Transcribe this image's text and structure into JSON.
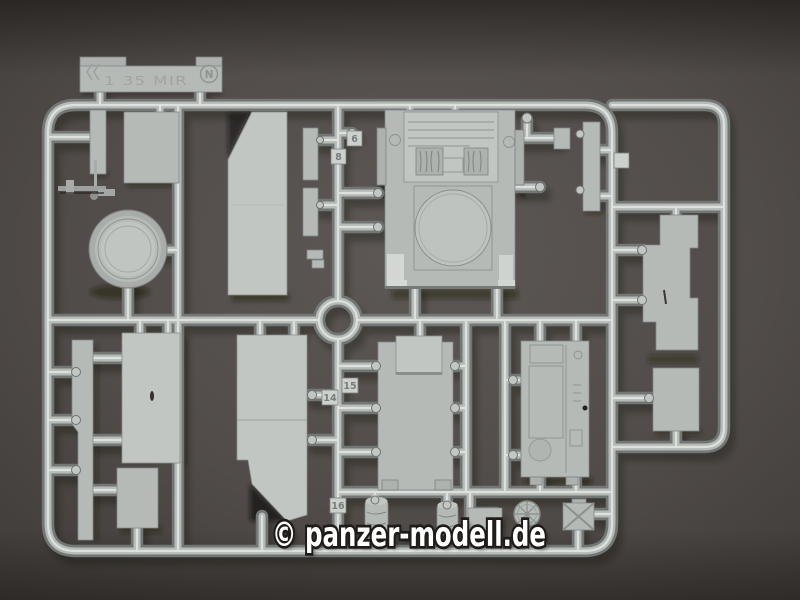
{
  "photo": {
    "watermark": "© panzer-modell.de",
    "sprue": {
      "letter_badge": "N",
      "molded_label": "1 35 MIR",
      "part_tags": [
        "6",
        "8",
        "14",
        "15",
        "16"
      ]
    },
    "colors": {
      "background": "#534e4b",
      "plastic": "#b6bab7",
      "plastic_highlight": "#e0e4e1",
      "plastic_shadow": "#787c7a",
      "watermark": "#ffffff"
    }
  }
}
